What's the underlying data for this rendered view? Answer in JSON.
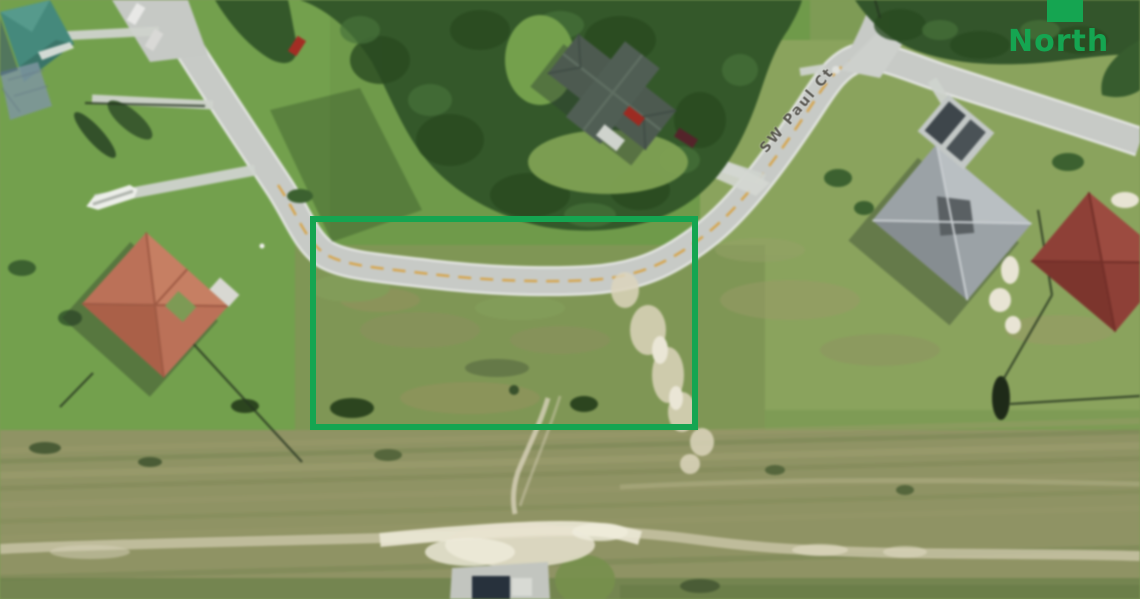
{
  "view": {
    "kind": "aerial-satellite-photo",
    "description": "Overhead satellite view of a residential neighborhood with a vacant corner lot outlined in green",
    "street_label": "SW Paul Ct"
  },
  "annotations": {
    "lot_outline": {
      "color": "#15a551",
      "stroke_px": "6"
    },
    "north": {
      "label": "North",
      "color": "#15a551"
    }
  },
  "scene_palette": {
    "grass": "#7e9b55",
    "scrub_field": "#8f9364",
    "road": "#c7cac6",
    "road_centerline_yellow": "#d7a03c",
    "tree_canopy": "#34582a",
    "sand_trail": "#dcd5bd",
    "teal_roof": "#45897c",
    "slate_roof": "#4d5a50",
    "orange_roof": "#bb7158",
    "gray_roof": "#9ba2a6",
    "maroon_roof": "#8e4037"
  }
}
